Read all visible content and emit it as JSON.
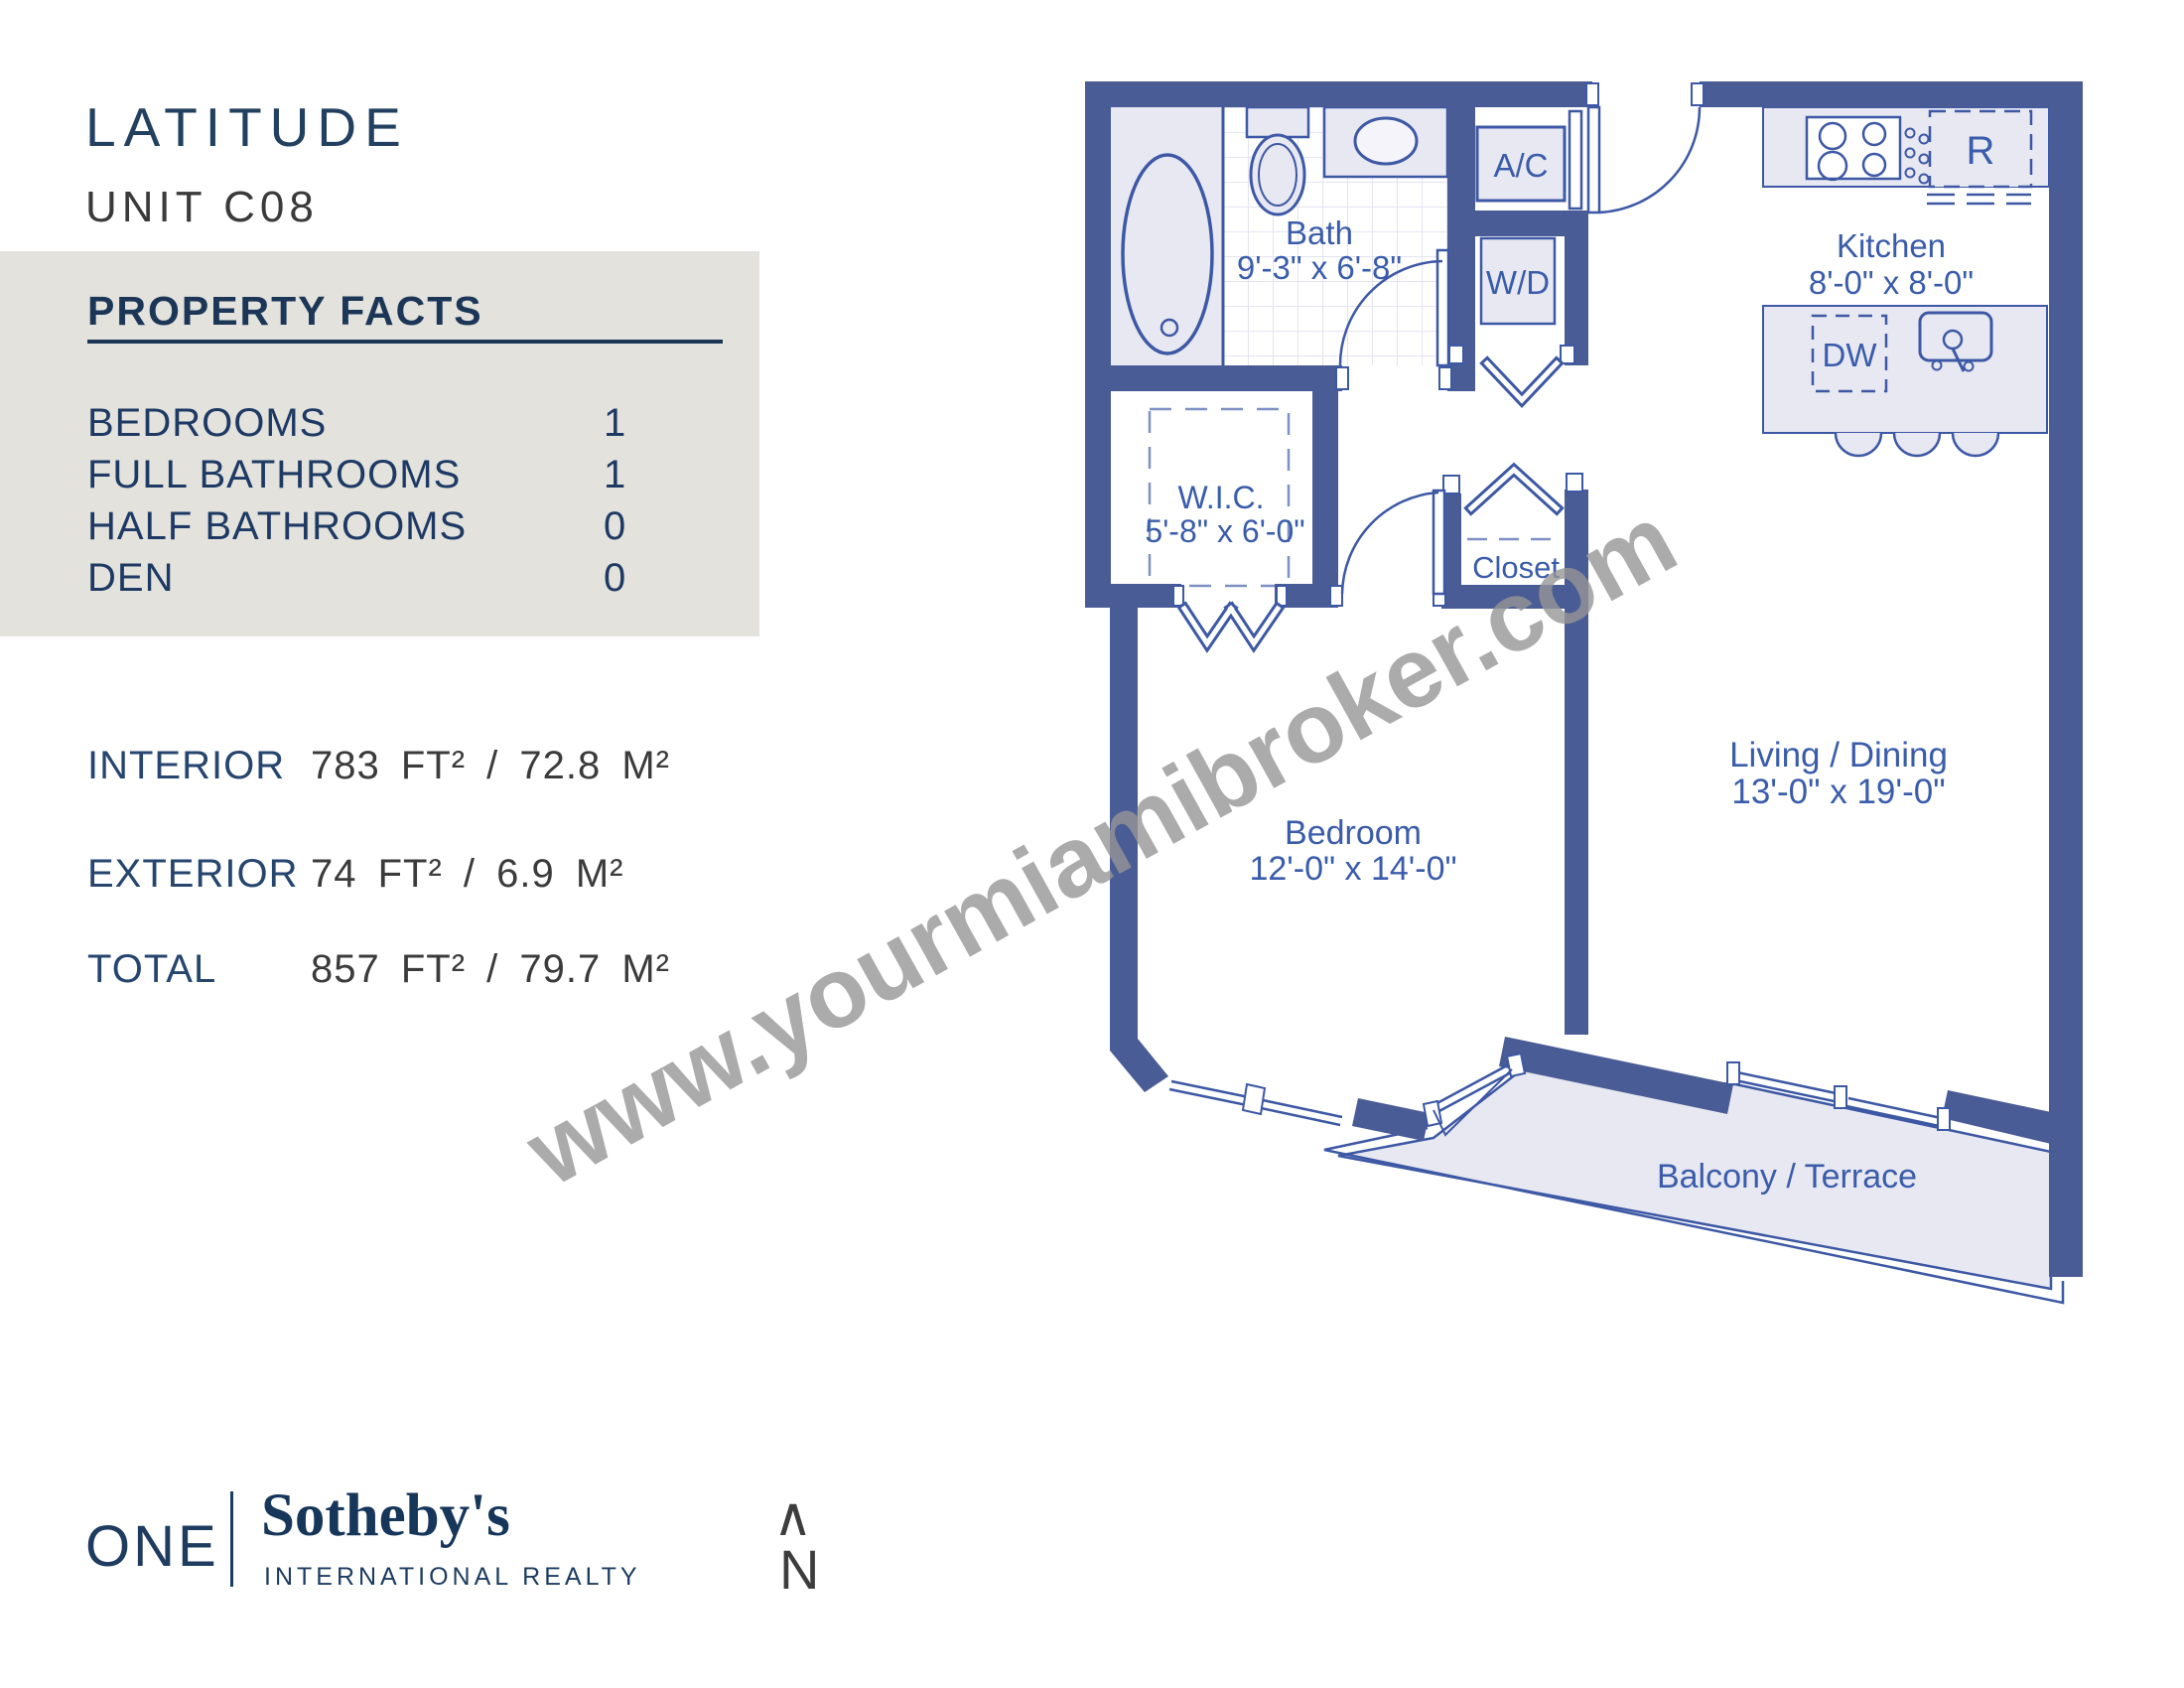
{
  "header": {
    "building": "LATITUDE",
    "unit": "UNIT C08"
  },
  "property_facts": {
    "title": "PROPERTY FACTS",
    "rows": [
      {
        "label": "BEDROOMS",
        "value": "1"
      },
      {
        "label": "FULL BATHROOMS",
        "value": "1"
      },
      {
        "label": "HALF BATHROOMS",
        "value": "0"
      },
      {
        "label": "DEN",
        "value": "0"
      }
    ]
  },
  "areas": {
    "rows": [
      {
        "label": "INTERIOR",
        "value": "783 FT² / 72.8 M²"
      },
      {
        "label": "EXTERIOR",
        "value": "74 FT² / 6.9 M²"
      },
      {
        "label": "TOTAL",
        "value": "857 FT² / 79.7 M²"
      }
    ]
  },
  "floor_plan": {
    "rooms": {
      "bath": {
        "name": "Bath",
        "dims": "9'-3\" x 6'-8\""
      },
      "wic": {
        "name": "W.I.C.",
        "dims": "5'-8\" x 6'-0\""
      },
      "closet": {
        "name": "Closet"
      },
      "bedroom": {
        "name": "Bedroom",
        "dims": "12'-0\" x 14'-0\""
      },
      "living": {
        "name": "Living / Dining",
        "dims": "13'-0\" x 19'-0\""
      },
      "kitchen": {
        "name": "Kitchen",
        "dims": "8'-0\" x 8'-0\""
      },
      "balcony": {
        "name": "Balcony / Terrace"
      }
    },
    "appliances": {
      "ac": "A/C",
      "wd": "W/D",
      "fridge": "R",
      "dishwasher": "DW"
    },
    "colors": {
      "wall": "#4a5c95",
      "line": "#3d58a4",
      "label": "#3a5caa",
      "fill": "#e8e8f2"
    }
  },
  "watermark": {
    "text": "www.yourmiamibroker.com"
  },
  "footer": {
    "logo_one": "ONE",
    "logo_brand": "Sotheby's",
    "logo_sub": "INTERNATIONAL REALTY",
    "north_symbol": "∧",
    "north_label": "N"
  }
}
